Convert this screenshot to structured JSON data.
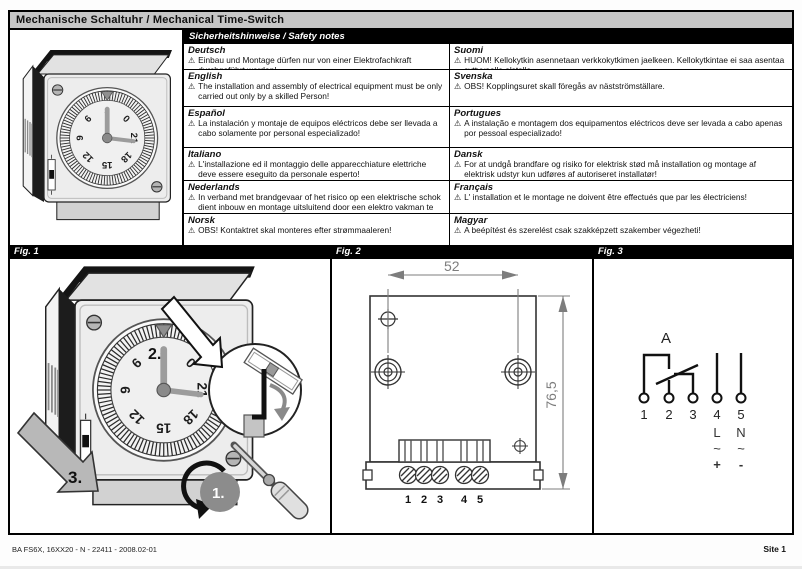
{
  "page": {
    "title": "Mechanische Schaltuhr / Mechanical Time-Switch",
    "footer_left": "BA FS6X, 16XX20 - N - 22411 - 2008.02-01",
    "footer_right": "Site 1"
  },
  "safety": {
    "header": "Sicherheitshinweise / Safety notes",
    "warning_symbol": "⚠",
    "rows": [
      {
        "left": {
          "lang": "Deutsch",
          "text": "Einbau und Montage dürfen nur von einer Elektrofachkraft durchgeführt werden!"
        },
        "right": {
          "lang": "Suomi",
          "text": "HUOM! Kellokytkin asennetaan verkkokytkimen jaelkeen. Kellokytkintae ei saa asentaa syttyvaelle alstalle."
        }
      },
      {
        "left": {
          "lang": "English",
          "text": "The installation and assembly of electrical equipment must be only carried out only by a skilled Person!"
        },
        "right": {
          "lang": "Svenska",
          "text": "OBS! Kopplingsuret skall föregås av nästströmställare."
        }
      },
      {
        "left": {
          "lang": "Español",
          "text": "La instalación y montaje de equipos eléctricos debe ser llevada a cabo solamente por personal especializado!"
        },
        "right": {
          "lang": "Portugues",
          "text": "A instalação e montagem dos equipamentos eléctricos deve ser levada a cabo apenas por pessoal especializado!"
        }
      },
      {
        "left": {
          "lang": "Italiano",
          "text": "L'installazione ed il montaggio delle apparecchiature elettriche deve essere eseguito da personale esperto!"
        },
        "right": {
          "lang": "Dansk",
          "text": "For at undgå brandfare og risiko for elektrisk stød må installation og montage af elektrisk udstyr kun udføres af autoriseret installatør!"
        }
      },
      {
        "left": {
          "lang": "Nederlands",
          "text": "In verband met brandgevaar of het risico op een elektrische schok dient inbouw en montage uitsluitend door een elektro vakman te geschieden!"
        },
        "right": {
          "lang": "Français",
          "text": "L' installation et le montage ne doivent être effectués que par les électriciens!"
        }
      },
      {
        "left": {
          "lang": "Norsk",
          "text": "OBS! Kontaktret skal monteres efter strømmaaleren!"
        },
        "right": {
          "lang": "Magyar",
          "text": "A beépítést és szerelést csak szakképzett szakember végezheti!"
        }
      }
    ]
  },
  "clock": {
    "numbers": [
      "3",
      "0",
      "21",
      "18",
      "15",
      "12",
      "9",
      "6"
    ]
  },
  "figures": {
    "fig1": {
      "label": "Fig. 1",
      "step1": "1.",
      "step2": "2.",
      "step3": "3."
    },
    "fig2": {
      "label": "Fig. 2",
      "dim_width": "52",
      "dim_height": "76,5",
      "terminals": [
        "1",
        "2",
        "3",
        "4",
        "5"
      ]
    },
    "fig3": {
      "label": "Fig. 3",
      "contact_label": "A",
      "terminals": [
        "1",
        "2",
        "3",
        "4",
        "5"
      ],
      "t4_lines": [
        "L",
        "~",
        "+"
      ],
      "t5_lines": [
        "N",
        "~",
        "-"
      ]
    }
  },
  "colors": {
    "bar_black": "#000000",
    "title_gray": "#c6c6c6",
    "dim_gray": "#7d7d7d"
  }
}
